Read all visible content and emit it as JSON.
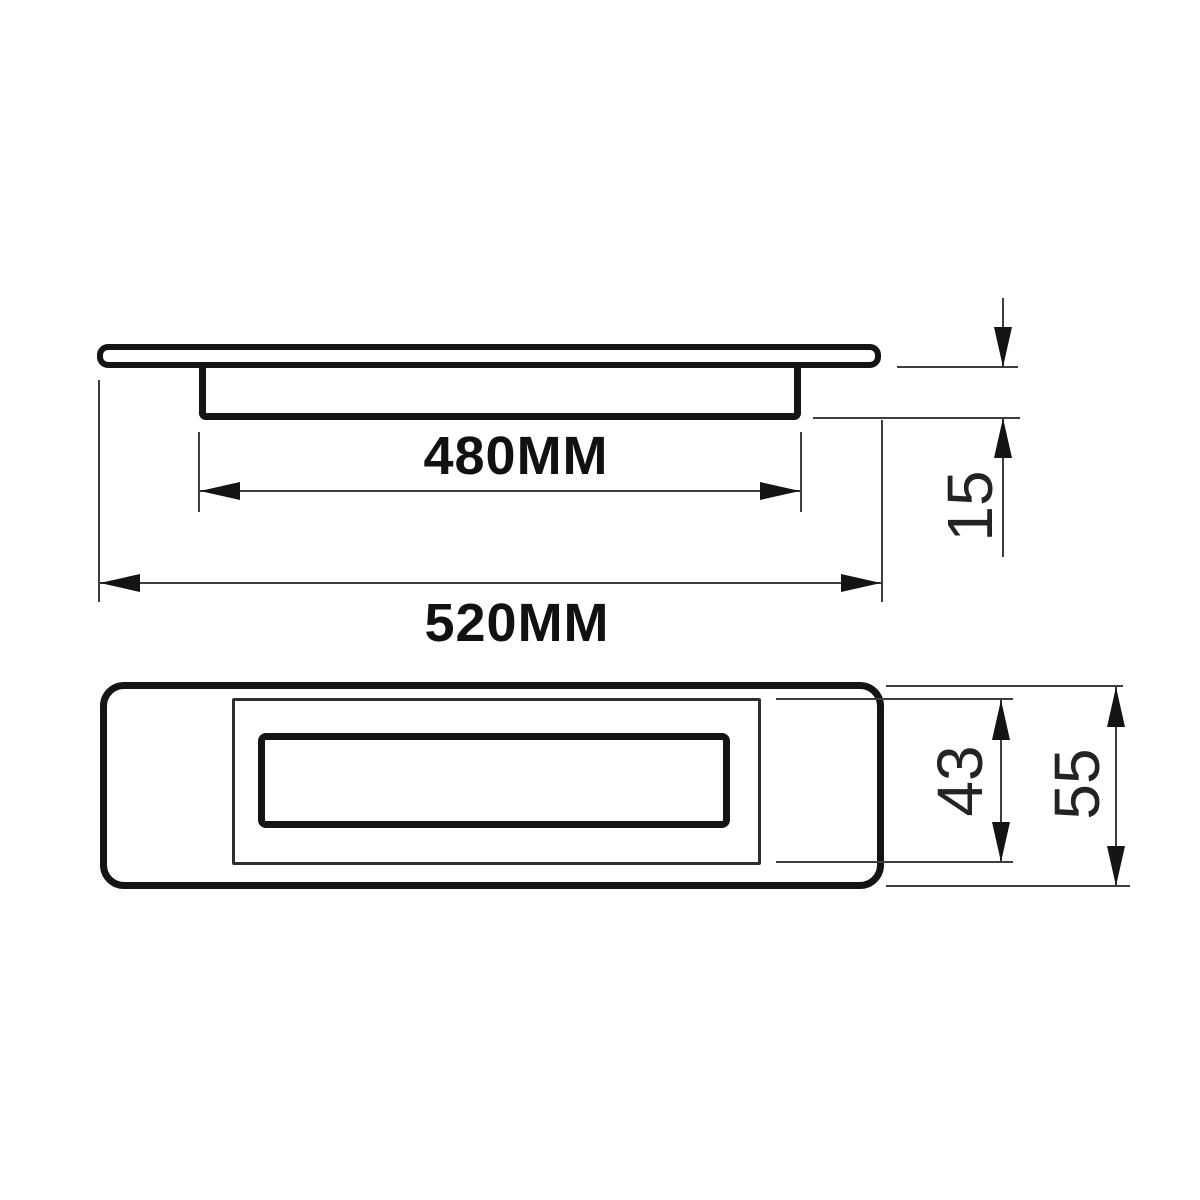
{
  "drawing": {
    "type": "technical-dimension-drawing",
    "part": "recessed flush pull handle",
    "background_color": "#ffffff",
    "line_color": "#141414",
    "dimensions": {
      "recess_width": "480MM",
      "overall_width": "520MM",
      "flange_depth": "15",
      "recess_height": "43",
      "overall_height": "55"
    }
  }
}
